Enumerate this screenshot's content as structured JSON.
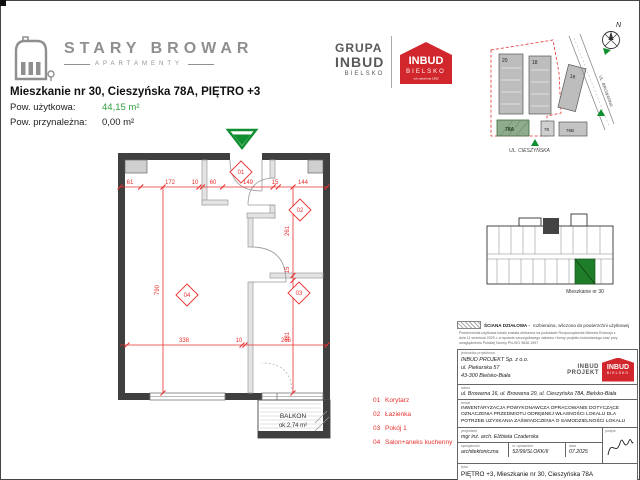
{
  "header": {
    "brand_name": "STARY BROWAR",
    "brand_sub": "APARTAMENTY",
    "grupa": {
      "l1": "GRUPA",
      "l2": "INBUD",
      "l3": "BIELSKO"
    },
    "inbud": {
      "l1": "INBUD",
      "l2": "BIELSKO",
      "l3": "rok założenia 1992"
    }
  },
  "title": {
    "heading": "Mieszkanie nr 30, Cieszyńska 78A, PIĘTRO +3",
    "usable_label": "Pow. użytkowa:",
    "usable_value": "44,15 m²",
    "adjacent_label": "Pow. przynależna:",
    "adjacent_value": "0,00 m²"
  },
  "plan": {
    "dims_top": [
      "61",
      "172",
      "10",
      "60",
      "149",
      "15",
      "144"
    ],
    "dims_mid": [
      "338",
      "10",
      "265"
    ],
    "dim_left": "790",
    "dims_right": [
      "261",
      "15",
      "381"
    ],
    "tags": [
      "01",
      "02",
      "03",
      "04"
    ],
    "balcony_name": "BALKON",
    "balcony_area": "ok.2,74 m²"
  },
  "site": {
    "north": "N",
    "street_bottom": "UL. CIESZYŃSKA",
    "street_right": "UL. BROWARNA",
    "b20": "20",
    "b18": "18",
    "b16": "16",
    "b78a": "78A",
    "b78": "78",
    "b76b": "76B"
  },
  "keyplan": {
    "label": "Mieszkanie nr 30"
  },
  "legend": {
    "items": [
      {
        "num": "01",
        "name": "Korytarz"
      },
      {
        "num": "02",
        "name": "Łazienka"
      },
      {
        "num": "03",
        "name": "Pokój 1"
      },
      {
        "num": "04",
        "name": "Salon+aneks kuchenny"
      }
    ]
  },
  "tb": {
    "wall_legend_title": "ŚCIANA DZIAŁOWA -",
    "wall_legend_rest": "rozbieralna, wliczona do powierzchni użytkowej",
    "disclaimer": "Powierzchnia użytkowa lokalu została obliczona na podstawie Rozporządzenia Ministra Rozwoju z dnia 11 września 2020 r. w sprawie szczegółowego zakresu i formy projektu budowlanego oraz przy uwzględnieniu Polskiej Normy PN-ISO 9836:1997",
    "unit_label": "jednostka projektowa",
    "company": "INBUD PROJEKT Sp. z o.o.",
    "company_addr1": "ul. Piekarska 57",
    "company_addr2": "43-300 Bielsko-Biała",
    "logo_l1": "INBUD",
    "logo_l2": "PROJEKT",
    "logo_red_l1": "INBUD",
    "logo_red_l2": "BIELSKO",
    "addr_label": "adres",
    "addr": "ul. Browarna 16, ul. Browarna 20, ul. Cieszyńska 78A,  Bielsko-Biała",
    "subject_label": "temat",
    "subject": "INWENTARYZACJA POWYKONAWCZA OPRACOWANIE DOTYCZĄCE OZNACZENIA PRZEDMIOTU ODRĘBNEJ WŁASNOŚCI LOKALU DLA POTRZEB UZYSKANIA ZAŚWIADCZENIA O SAMODZIELNOŚCI LOKALU",
    "designer_label": "projektant",
    "designer": "mgr inż. arch. Elżbieta Czaderska",
    "sign_label": "podpis",
    "spec_label": "specjalność",
    "spec": "architektoniczna",
    "lic_label": "nr uprawnień",
    "lic": "52/99/SLOKK/II",
    "date_label": "data",
    "date": "07.2025",
    "drawing_label": "tytuł",
    "drawing": "PIĘTRO +3, Mieszkanie nr 30, Cieszyńska 78A"
  },
  "colors": {
    "dim_red": "#e8302e",
    "entry_green": "#0f8f2f",
    "area_green": "#2f9e3f",
    "wall_dark": "#3f3f3f",
    "brand_gray": "#8f8f8f",
    "inbud_red": "#d1262b"
  }
}
